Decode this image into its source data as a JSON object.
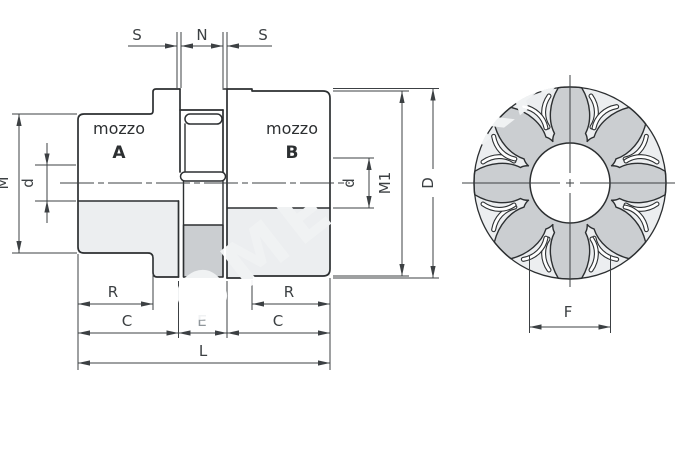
{
  "drawing": {
    "side_view": {
      "hub_a": {
        "line1": "mozzo",
        "line2": "A"
      },
      "hub_b": {
        "line1": "mozzo",
        "line2": "B"
      },
      "dims_top": {
        "s_left": "S",
        "n": "N",
        "s_right": "S"
      },
      "dims_left": {
        "m": "M",
        "d": "d"
      },
      "dims_right": {
        "d": "d",
        "m1": "M1",
        "outer_diameter": "D"
      },
      "dims_bottom": {
        "r_left": "R",
        "c_left": "C",
        "e": "E",
        "c_right": "C",
        "r_right": "R",
        "l": "L"
      }
    },
    "front_view": {
      "dim_f": "F",
      "petal_count": 8
    },
    "watermark": {
      "text_left": "OME",
      "text_right": "KA"
    },
    "colors": {
      "background": "#ffffff",
      "outline": "#2c2f31",
      "dimension": "#3c4043",
      "fill_light": "#eceef0",
      "fill_medium": "#cbced1",
      "label_faded": "#8f969b",
      "watermark": "#f0f2f3"
    }
  }
}
